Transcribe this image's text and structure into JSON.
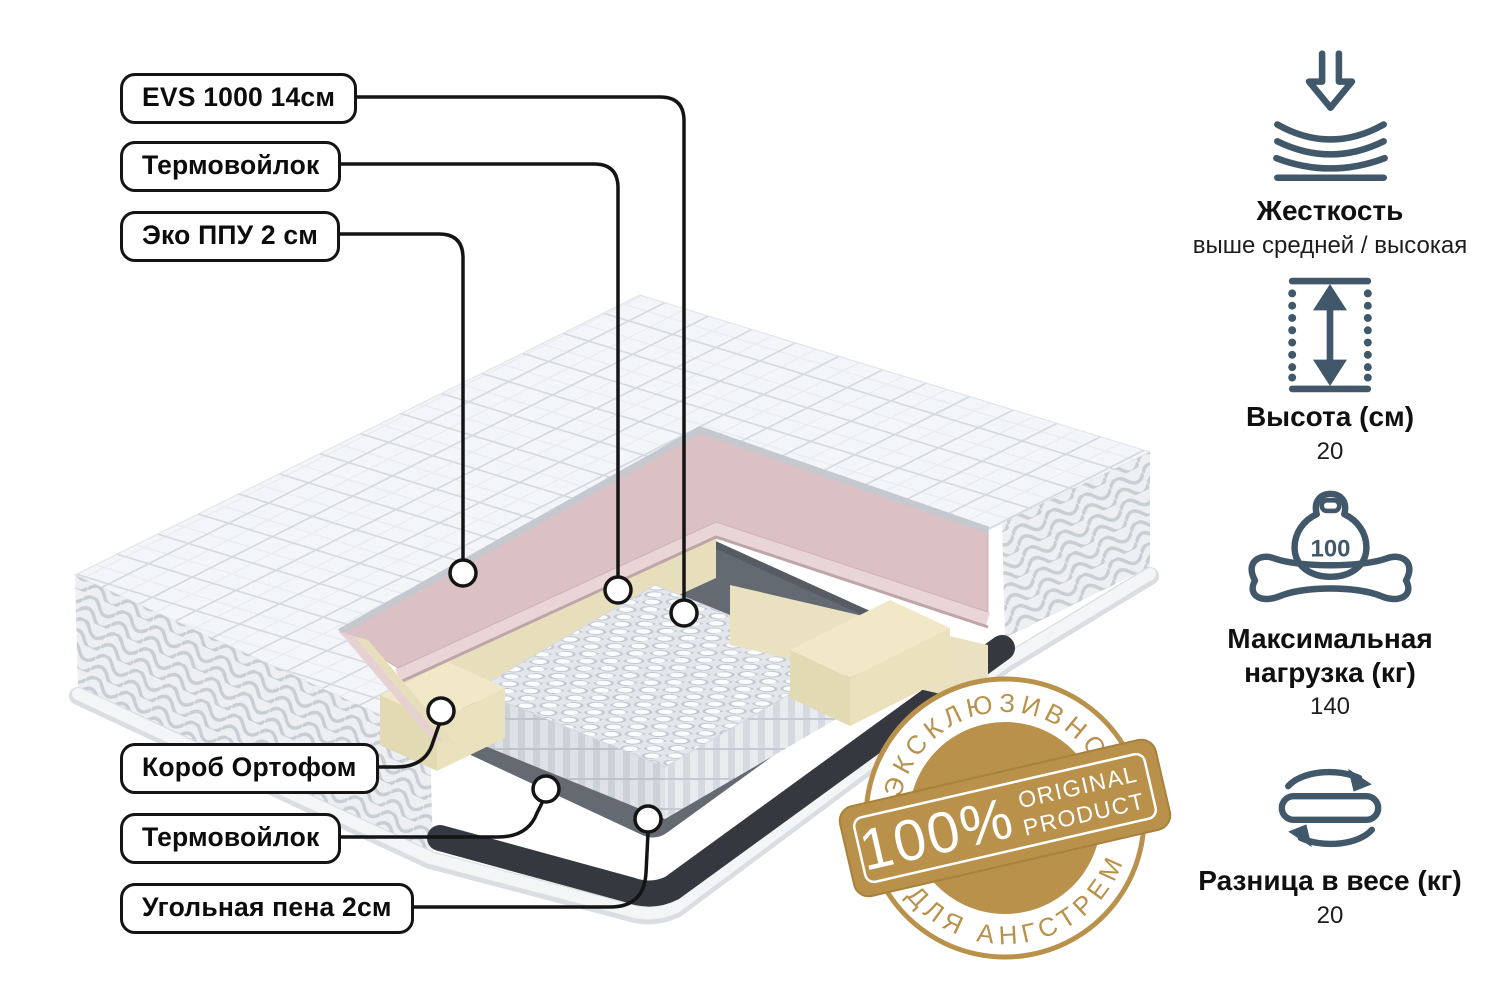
{
  "callout_labels": [
    {
      "text": "EVS 1000 14см"
    },
    {
      "text": "Термовойлок"
    },
    {
      "text": "Эко ППУ 2 см"
    },
    {
      "text": "Короб Ортофом"
    },
    {
      "text": "Термовойлок"
    },
    {
      "text": "Угольная пена 2см"
    }
  ],
  "specs": [
    {
      "icon": "firmness-icon",
      "title": "Жесткость",
      "value": "выше средней / высокая"
    },
    {
      "icon": "height-icon",
      "title": "Высота (см)",
      "value": "20"
    },
    {
      "icon": "max-load-icon",
      "title": "Максимальная нагрузка (кг)",
      "value": "140",
      "icon_number": "100"
    },
    {
      "icon": "weight-difference-icon",
      "title": "Разница в весе (кг)",
      "value": "20"
    }
  ],
  "badge": {
    "top_arc": "ЭКСКЛЮЗИВНО",
    "percent": "100%",
    "original_line1": "ORIGINAL",
    "original_line2": "PRODUCT",
    "bottom_arc": "ДЛЯ АНГСТРЕМ"
  },
  "colors": {
    "gold": "#b9914b",
    "icon": "#41586a",
    "pink_layer": "#dbc0c4",
    "foam_cream": "#e9e1c0",
    "felt_gray": "#646a72",
    "charcoal": "#35393f",
    "label_border": "#141414"
  }
}
